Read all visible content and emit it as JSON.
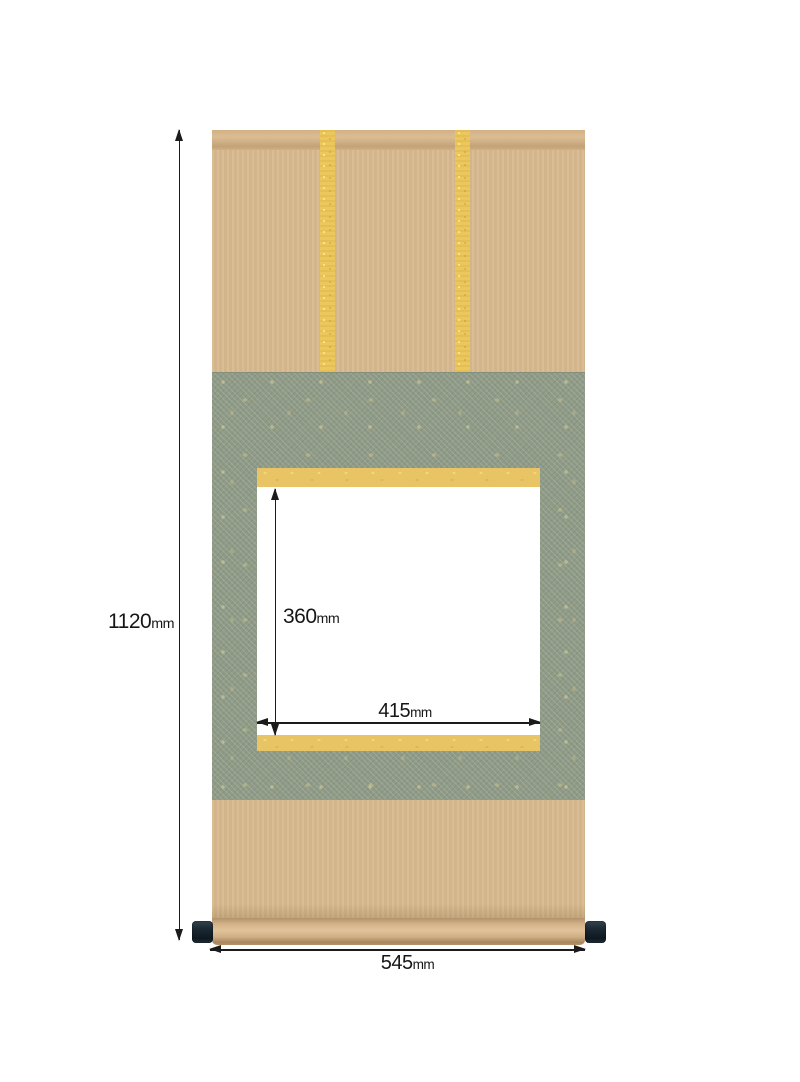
{
  "diagram": {
    "subject": "hanging-scroll-mounting-dimensions",
    "measurements": {
      "total_height": {
        "value": "1120",
        "unit": "mm"
      },
      "total_width": {
        "value": "545",
        "unit": "mm"
      },
      "artwork_height": {
        "value": "360",
        "unit": "mm"
      },
      "artwork_width": {
        "value": "415",
        "unit": "mm"
      }
    },
    "colors": {
      "fabric_tan": "#d8b98e",
      "mounting_green": "#8f9b87",
      "ichimonji_gold": "#e9c464",
      "futai_yellow": "#ecc75e",
      "roller_end_cap_dark": "#18242e",
      "artwork_area_white": "#ffffff",
      "dimension_ink": "#1b1b1b",
      "background": "#ffffff"
    }
  }
}
